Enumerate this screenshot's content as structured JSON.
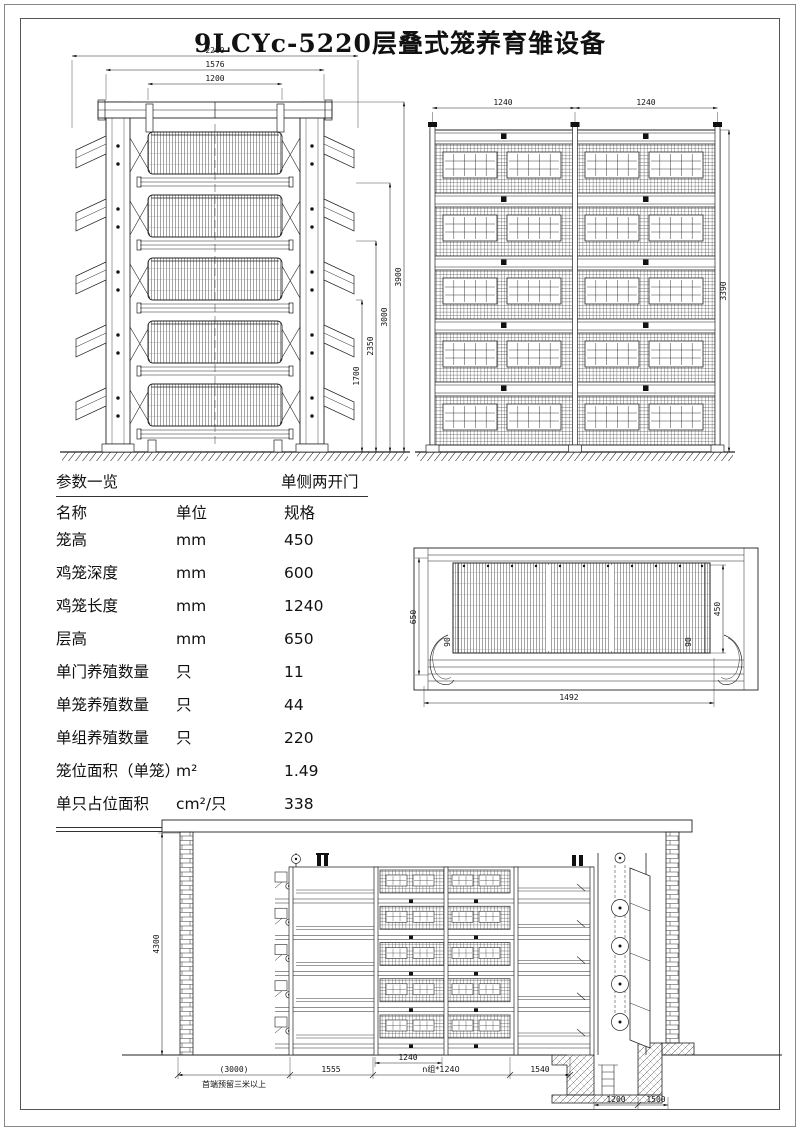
{
  "title": "9LCYc-5220层叠式笼养育雏设备",
  "table": {
    "title": "参数一览",
    "door_type": "单侧两开门",
    "headers": {
      "name": "名称",
      "unit": "单位",
      "spec": "规格"
    },
    "rows": [
      {
        "name": "笼高",
        "unit": "mm",
        "spec": "450"
      },
      {
        "name": "鸡笼深度",
        "unit": "mm",
        "spec": "600"
      },
      {
        "name": "鸡笼长度",
        "unit": "mm",
        "spec": "1240"
      },
      {
        "name": "层高",
        "unit": "mm",
        "spec": "650"
      },
      {
        "name": "单门养殖数量",
        "unit": "只",
        "spec": "11"
      },
      {
        "name": "单笼养殖数量",
        "unit": "只",
        "spec": "44"
      },
      {
        "name": "单组养殖数量",
        "unit": "只",
        "spec": "220"
      },
      {
        "name": "笼位面积（单笼）",
        "unit": "m²",
        "spec": "1.49"
      },
      {
        "name": "单只占位面积",
        "unit": "cm²/只",
        "spec": "338"
      }
    ]
  },
  "side_view": {
    "w2260": "2260",
    "w1576": "1576",
    "w1200": "1200",
    "h1700": "1700",
    "h2350": "2350",
    "h3000": "3000",
    "h3900": "3900"
  },
  "front_view": {
    "w_left": "1240",
    "w_right": "1240",
    "h3390": "3390"
  },
  "cage_detail": {
    "h650": "650",
    "h450": "450",
    "w1492": "1492",
    "s90l": "90",
    "s90r": "90"
  },
  "section_view": {
    "h4300": "4300",
    "w3000": "(3000)",
    "note": "首端预留三米以上",
    "w1555": "1555",
    "w1240": "1240",
    "wn1240": "n组*1240",
    "w1540": "1540",
    "w1200": "1200",
    "w1500": "1500"
  }
}
